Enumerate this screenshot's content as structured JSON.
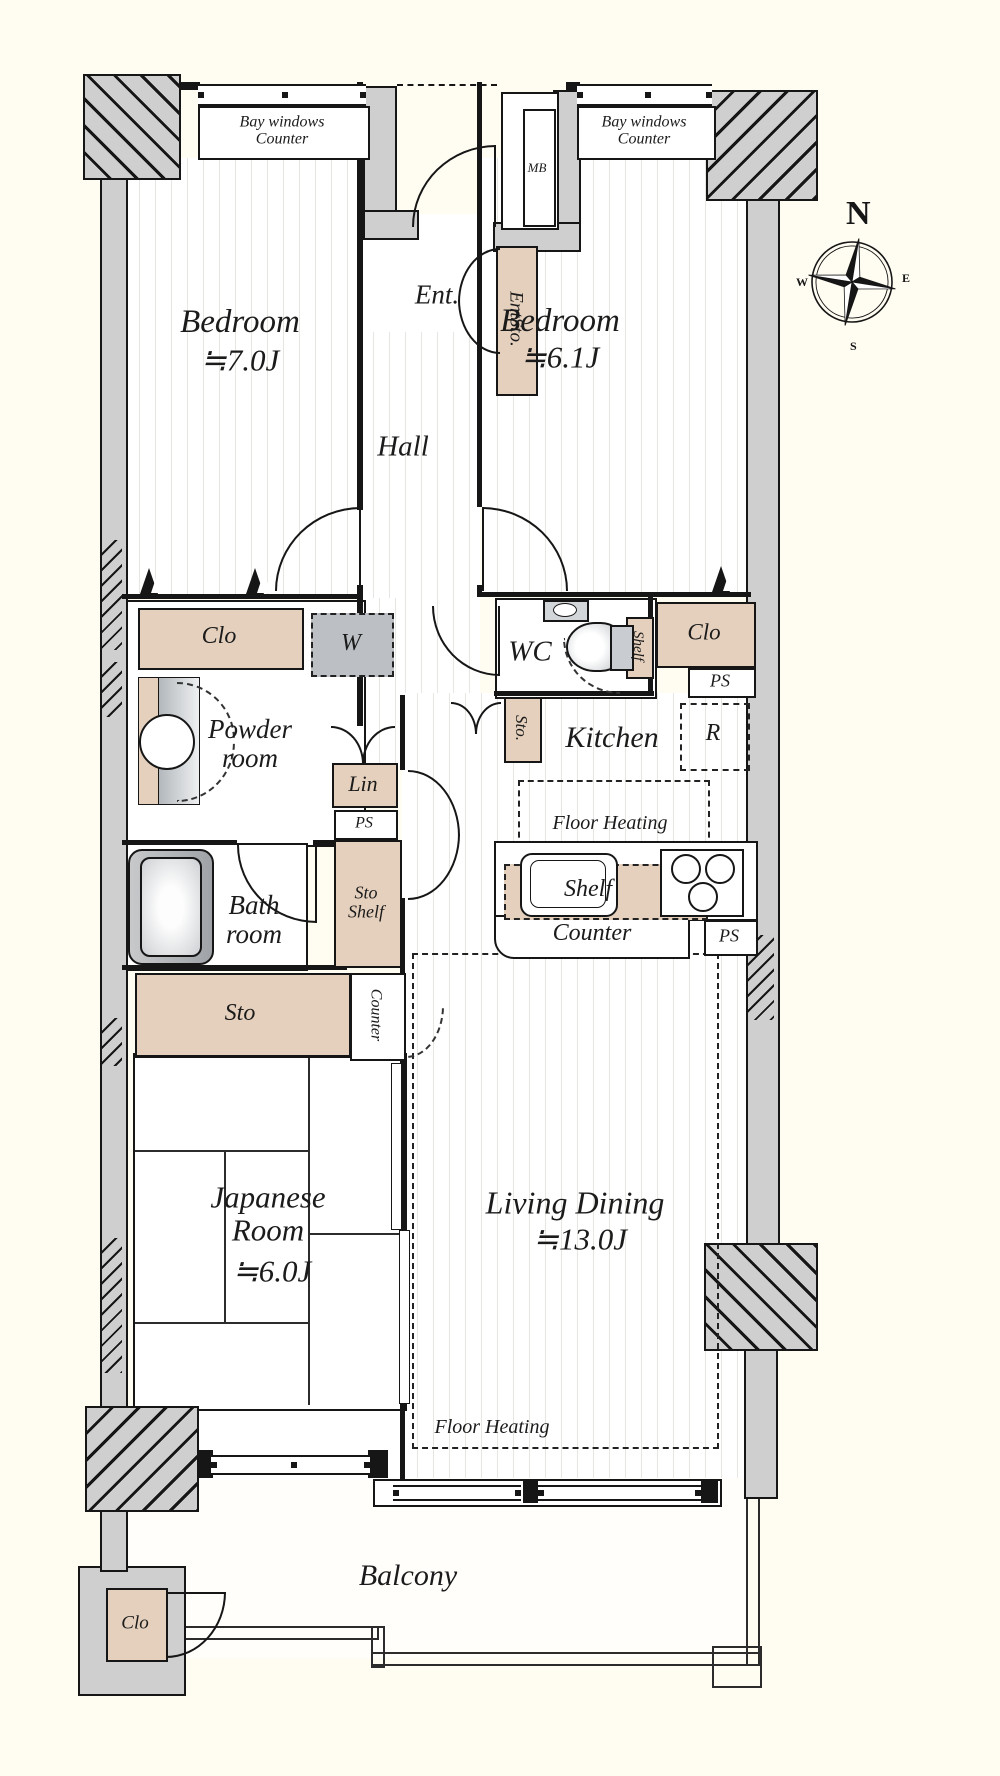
{
  "compass": {
    "n": "N",
    "e": "E",
    "s": "S",
    "w": "W"
  },
  "labels": {
    "bay1_line1": "Bay windows",
    "bay1_line2": "Counter",
    "bay2_line1": "Bay windows",
    "bay2_line2": "Counter",
    "mb": "MB",
    "ent": "Ent.",
    "entsto": "EntSto.",
    "bedroom1_name": "Bedroom",
    "bedroom1_size": "≒7.0J",
    "bedroom2_name": "Bedroom",
    "bedroom2_size": "≒6.1J",
    "hall": "Hall",
    "clo_left": "Clo",
    "w_box": "W",
    "wc": "WC",
    "shelf_wc": "Shelf",
    "clo_right": "Clo",
    "ps_top": "PS",
    "powder_line1": "Powder",
    "powder_line2": "room",
    "lin": "Lin",
    "ps_left": "PS",
    "sto_hall": "Sto.",
    "kitchen": "Kitchen",
    "r_box": "R",
    "fh_kitchen": "Floor Heating",
    "bath_line1": "Bath",
    "bath_line2": "room",
    "stoshelf_line1": "Sto",
    "stoshelf_line2": "Shelf",
    "shelf_kitchen": "Shelf",
    "counter_kitchen": "Counter",
    "ps_counter": "PS",
    "sto": "Sto",
    "counter_vert": "Counter",
    "japanese_line1": "Japanese",
    "japanese_line2": "Room",
    "japanese_size": "≒6.0J",
    "living_name": "Living Dining",
    "living_size": "≒13.0J",
    "fh_living": "Floor Heating",
    "balcony": "Balcony",
    "clo_balcony": "Clo"
  }
}
